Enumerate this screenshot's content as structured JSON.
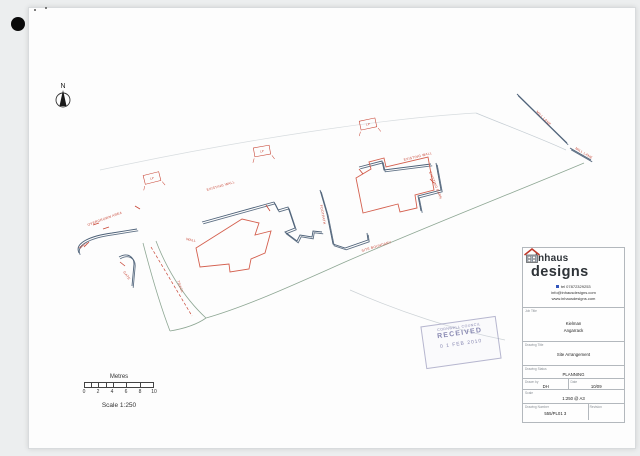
{
  "north": {
    "label": "N"
  },
  "scalebar": {
    "title": "Metres",
    "ticks": [
      "0",
      "2",
      "4",
      "6",
      "8",
      "10"
    ],
    "scale_text": "Scale 1:250"
  },
  "logo": {
    "name_top": "inhaus",
    "name_bottom": "designs"
  },
  "contact": {
    "tel": "tel 07872329253",
    "email": "info@inhausdesigns.com",
    "web": "www.inhausdesigns.com"
  },
  "titleblock": {
    "job_title_label": "Job Title",
    "job_title_line1": "Kielman",
    "job_title_line2": "Angarrack",
    "drawing_title_label": "Drawing Title",
    "drawing_title": "Site Arrangement",
    "status_label": "Drawing Status",
    "status": "PLANNING",
    "drawn_by_label": "Drawn by",
    "drawn_by": "DH",
    "date_label": "Date",
    "date": "10/09",
    "scale_label": "Scale",
    "scale": "1:250 @ A3",
    "number_label": "Drawing Number",
    "number": "555/PL01 3",
    "revision_label": "Revision"
  },
  "stamp": {
    "line1": "CORNWALL COUNCIL",
    "line2": "RECEIVED",
    "line3": "0 1 FEB 2010"
  },
  "plan": {
    "colors": {
      "wall": "#4d6178",
      "building": "#d4604f",
      "road": "#8ea794",
      "annotation": "#c84636"
    },
    "annotations": [
      {
        "text": "OVERGROWN AREA"
      },
      {
        "text": "EXISTING WALL"
      },
      {
        "text": "EXISTING WALL"
      },
      {
        "text": "EXISTING BARN"
      },
      {
        "text": "FOOTPATH"
      },
      {
        "text": "SITE BOUNDARY"
      },
      {
        "text": "MILL LANE"
      },
      {
        "text": "MILL LANE"
      },
      {
        "text": "TRACK"
      },
      {
        "text": "GATE"
      },
      {
        "text": "WALL"
      },
      {
        "text": "WALL"
      }
    ],
    "boxes": [
      {
        "text": "LP"
      },
      {
        "text": "LP"
      },
      {
        "text": "LP"
      }
    ]
  }
}
